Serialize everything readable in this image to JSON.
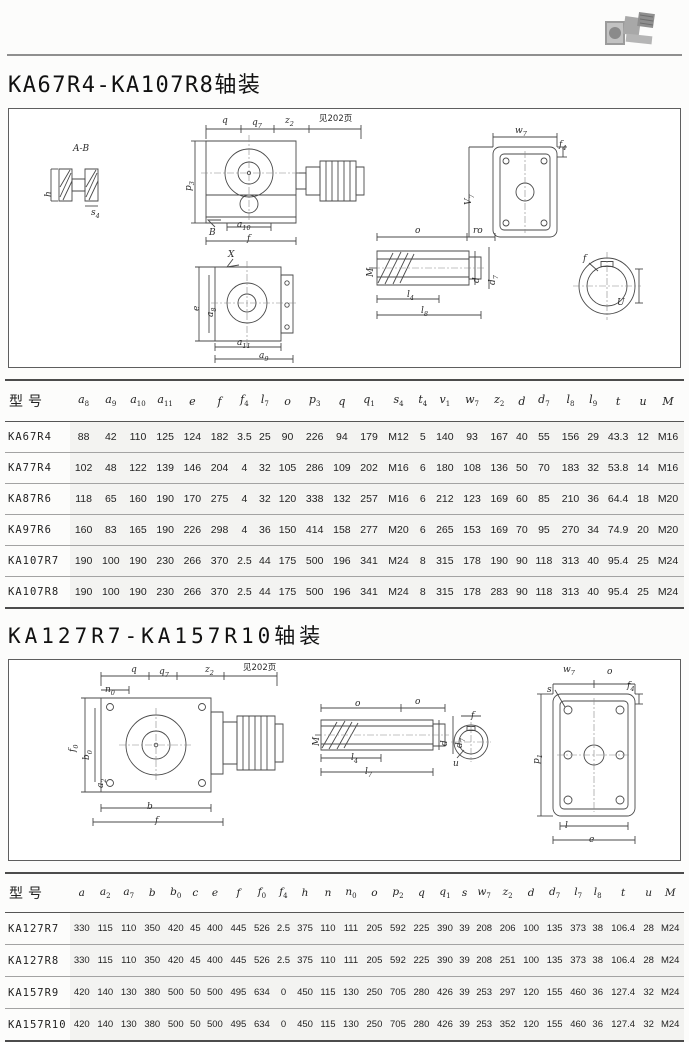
{
  "colors": {
    "rule": "#8f8f8f",
    "drawing_line": "#4a4a4a",
    "table_rule": "#a3a3a3",
    "shade": "#f3f3f1"
  },
  "header": {
    "photo_icon": "gearmotor-photo"
  },
  "section1": {
    "title": "KA67R4-KA107R8轴装",
    "diagram_labels": [
      {
        "t": "A-B",
        "x": 64,
        "y": 36
      },
      {
        "t": "h",
        "x": 36,
        "y": 88,
        "v": 1
      },
      {
        "t": "s_4",
        "x": 82,
        "y": 100
      },
      {
        "t": "q",
        "x": 213,
        "y": 8
      },
      {
        "t": "q_7",
        "x": 243,
        "y": 10
      },
      {
        "t": "z_2",
        "x": 276,
        "y": 8
      },
      {
        "t": "见202页",
        "x": 310,
        "y": 6,
        "cn": 1
      },
      {
        "t": "p_3",
        "x": 176,
        "y": 82,
        "v": 1
      },
      {
        "t": "B",
        "x": 200,
        "y": 120
      },
      {
        "t": "a_10",
        "x": 228,
        "y": 112
      },
      {
        "t": "f",
        "x": 238,
        "y": 126
      },
      {
        "t": "X",
        "x": 219,
        "y": 142
      },
      {
        "t": "e",
        "x": 184,
        "y": 202,
        "v": 1
      },
      {
        "t": "a_8",
        "x": 198,
        "y": 208,
        "v": 1
      },
      {
        "t": "a_11",
        "x": 228,
        "y": 230
      },
      {
        "t": "a_9",
        "x": 250,
        "y": 243
      },
      {
        "t": "o",
        "x": 406,
        "y": 118
      },
      {
        "t": "ro",
        "x": 464,
        "y": 118
      },
      {
        "t": "M",
        "x": 358,
        "y": 168,
        "v": 1
      },
      {
        "t": "d",
        "x": 464,
        "y": 174,
        "v": 1
      },
      {
        "t": "d_7",
        "x": 480,
        "y": 176,
        "v": 1
      },
      {
        "t": "l_4",
        "x": 398,
        "y": 182
      },
      {
        "t": "l_8",
        "x": 412,
        "y": 198
      },
      {
        "t": "w_7",
        "x": 506,
        "y": 18
      },
      {
        "t": "f_4",
        "x": 550,
        "y": 32
      },
      {
        "t": "V_7",
        "x": 456,
        "y": 96,
        "v": 1
      },
      {
        "t": "f",
        "x": 574,
        "y": 146
      },
      {
        "t": "U",
        "x": 608,
        "y": 190
      }
    ],
    "table": {
      "columns": [
        "型号",
        "a_8",
        "a_9",
        "a_10",
        "a_11",
        "e",
        "f",
        "f_4",
        "l_7",
        "o",
        "p_3",
        "q",
        "q_1",
        "s_4",
        "t_4",
        "v_1",
        "w_7",
        "z_2",
        "d",
        "d_7",
        "l_8",
        "l_9",
        "t",
        "u",
        "M"
      ],
      "rows": [
        [
          "KA67R4",
          88,
          42,
          110,
          125,
          124,
          182,
          3.5,
          25,
          90,
          226,
          94,
          179,
          "M12",
          5,
          140,
          93,
          167,
          40,
          55,
          156,
          29,
          43.3,
          12,
          "M16"
        ],
        [
          "KA77R4",
          102,
          48,
          122,
          139,
          146,
          204,
          4,
          32,
          105,
          286,
          109,
          202,
          "M16",
          6,
          180,
          108,
          136,
          50,
          70,
          183,
          32,
          53.8,
          14,
          "M16"
        ],
        [
          "KA87R6",
          118,
          65,
          160,
          190,
          170,
          275,
          4,
          32,
          120,
          338,
          132,
          257,
          "M16",
          6,
          212,
          123,
          169,
          60,
          85,
          210,
          36,
          64.4,
          18,
          "M20"
        ],
        [
          "KA97R6",
          160,
          83,
          165,
          190,
          226,
          298,
          4,
          36,
          150,
          414,
          158,
          277,
          "M20",
          6,
          265,
          153,
          169,
          70,
          95,
          270,
          34,
          74.9,
          20,
          "M20"
        ],
        [
          "KA107R7",
          190,
          100,
          190,
          230,
          266,
          370,
          2.5,
          44,
          175,
          500,
          196,
          341,
          "M24",
          8,
          315,
          178,
          190,
          90,
          118,
          313,
          40,
          95.4,
          25,
          "M24"
        ],
        [
          "KA107R8",
          190,
          100,
          190,
          230,
          266,
          370,
          2.5,
          44,
          175,
          500,
          196,
          341,
          "M24",
          8,
          315,
          178,
          283,
          90,
          118,
          313,
          40,
          95.4,
          25,
          "M24"
        ]
      ]
    }
  },
  "section2": {
    "title": "KA127R7-KA157R10轴装",
    "diagram_labels": [
      {
        "t": "q",
        "x": 122,
        "y": 6
      },
      {
        "t": "q_7",
        "x": 150,
        "y": 8
      },
      {
        "t": "z_2",
        "x": 196,
        "y": 6
      },
      {
        "t": "见202页",
        "x": 234,
        "y": 4,
        "cn": 1
      },
      {
        "t": "n_0",
        "x": 96,
        "y": 26
      },
      {
        "t": "f_0",
        "x": 60,
        "y": 92,
        "v": 1
      },
      {
        "t": "b_0",
        "x": 74,
        "y": 100,
        "v": 1
      },
      {
        "t": "a_2",
        "x": 88,
        "y": 128,
        "v": 1
      },
      {
        "t": "b",
        "x": 138,
        "y": 143
      },
      {
        "t": "f",
        "x": 146,
        "y": 157
      },
      {
        "t": "o",
        "x": 346,
        "y": 40
      },
      {
        "t": "o",
        "x": 406,
        "y": 38
      },
      {
        "t": "M",
        "x": 304,
        "y": 86,
        "v": 1
      },
      {
        "t": "d",
        "x": 432,
        "y": 86,
        "v": 1
      },
      {
        "t": "d_7",
        "x": 447,
        "y": 88,
        "v": 1
      },
      {
        "t": "l_4",
        "x": 342,
        "y": 94
      },
      {
        "t": "l_7",
        "x": 356,
        "y": 108
      },
      {
        "t": "u",
        "x": 444,
        "y": 100
      },
      {
        "t": "f",
        "x": 462,
        "y": 52
      },
      {
        "t": "w_7",
        "x": 554,
        "y": 6
      },
      {
        "t": "o",
        "x": 598,
        "y": 8
      },
      {
        "t": "s",
        "x": 538,
        "y": 26
      },
      {
        "t": "f_4",
        "x": 618,
        "y": 22
      },
      {
        "t": "p_1",
        "x": 524,
        "y": 104,
        "v": 1
      },
      {
        "t": "l",
        "x": 556,
        "y": 162
      },
      {
        "t": "e",
        "x": 580,
        "y": 176
      }
    ],
    "table": {
      "columns": [
        "型号",
        "a",
        "a_2",
        "a_7",
        "b",
        "b_0",
        "c",
        "e",
        "f",
        "f_0",
        "f_4",
        "h",
        "n",
        "n_0",
        "o",
        "p_2",
        "q",
        "q_1",
        "s",
        "w_7",
        "z_2",
        "d",
        "d_7",
        "l_7",
        "l_8",
        "t",
        "u",
        "M"
      ],
      "rows": [
        [
          "KA127R7",
          330,
          115,
          110,
          350,
          420,
          45,
          400,
          445,
          526,
          2.5,
          375,
          110,
          111,
          205,
          592,
          225,
          390,
          39,
          208,
          206,
          100,
          135,
          373,
          38,
          106.4,
          28,
          "M24"
        ],
        [
          "KA127R8",
          330,
          115,
          110,
          350,
          420,
          45,
          400,
          445,
          526,
          2.5,
          375,
          110,
          111,
          205,
          592,
          225,
          390,
          39,
          208,
          251,
          100,
          135,
          373,
          38,
          106.4,
          28,
          "M24"
        ],
        [
          "KA157R9",
          420,
          140,
          130,
          380,
          500,
          50,
          500,
          495,
          634,
          0,
          450,
          115,
          130,
          250,
          705,
          280,
          426,
          39,
          253,
          297,
          120,
          155,
          460,
          36,
          127.4,
          32,
          "M24"
        ],
        [
          "KA157R10",
          420,
          140,
          130,
          380,
          500,
          50,
          500,
          495,
          634,
          0,
          450,
          115,
          130,
          250,
          705,
          280,
          426,
          39,
          253,
          352,
          120,
          155,
          460,
          36,
          127.4,
          32,
          "M24"
        ]
      ]
    }
  }
}
